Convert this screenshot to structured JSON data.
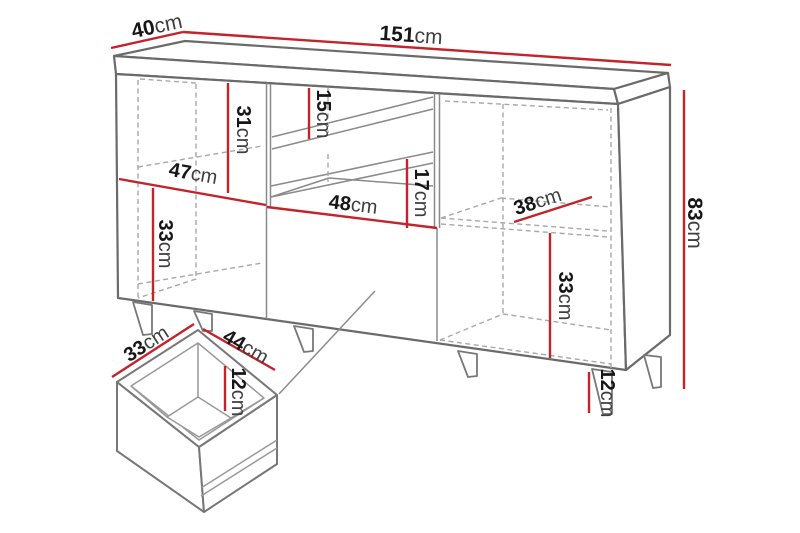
{
  "diagram": {
    "name": "sideboard-dimension-diagram",
    "background": "#ffffff",
    "colors": {
      "dimension_line": "#c4232b",
      "outline": "#6a6a6a",
      "hidden_line": "#a8a8a8",
      "number_text": "#161616",
      "unit_text": "#3f3f3f"
    },
    "unit": "cm",
    "dimensions": {
      "depth": {
        "value": "40",
        "unit": "cm"
      },
      "width": {
        "value": "151",
        "unit": "cm"
      },
      "height": {
        "value": "83",
        "unit": "cm"
      },
      "left_upper_compartment_height": {
        "value": "31",
        "unit": "cm"
      },
      "left_compartment_width": {
        "value": "47",
        "unit": "cm"
      },
      "left_lower_compartment_height": {
        "value": "33",
        "unit": "cm"
      },
      "niche_upper_height": {
        "value": "15",
        "unit": "cm"
      },
      "niche_lower_height": {
        "value": "17",
        "unit": "cm"
      },
      "niche_width": {
        "value": "48",
        "unit": "cm"
      },
      "right_compartment_depth": {
        "value": "38",
        "unit": "cm"
      },
      "right_compartment_height": {
        "value": "33",
        "unit": "cm"
      },
      "leg_height": {
        "value": "12",
        "unit": "cm"
      },
      "drawer_depth": {
        "value": "33",
        "unit": "cm"
      },
      "drawer_width": {
        "value": "44",
        "unit": "cm"
      },
      "drawer_inner_height": {
        "value": "12",
        "unit": "cm"
      }
    }
  }
}
